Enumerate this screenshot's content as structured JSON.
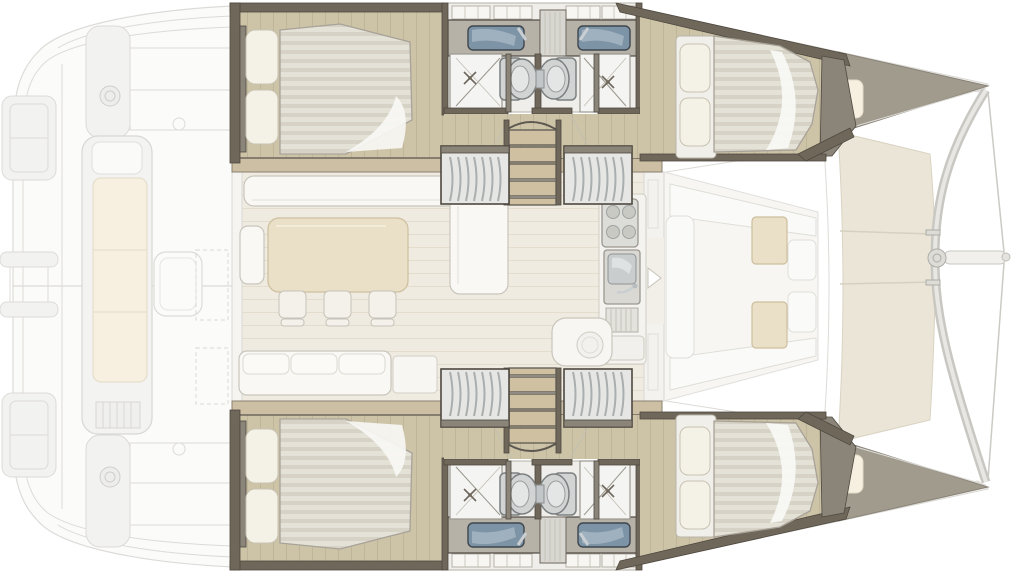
{
  "meta": {
    "title": "Catamaran interior floor plan (top-down)",
    "orientation": "bow-right-stern-left",
    "style": "rendered architectural layout, exterior decks ghosted"
  },
  "vessel": {
    "type": "sailing-catamaran",
    "double-cabins": 4,
    "double-berths": 4,
    "bathrooms": 4,
    "showers": 4,
    "toilets": 4,
    "washbasins": 4,
    "wardrobes": 4,
    "companionway-stairs": 2,
    "saloon-dining-chairs": 3,
    "stove-burners": 4,
    "forward-cockpit-tables": 2,
    "aft-cockpit-tables": 1,
    "trampoline-panels": 3
  },
  "rooms": [
    {
      "id": "aft-cockpit",
      "desc": "ghosted aft cockpit with long bench, table and davits"
    },
    {
      "id": "saloon",
      "desc": "saloon with L-sofa, dining table, three chairs and galley"
    },
    {
      "id": "galley",
      "desc": "galley strip with stove, sink and drainer"
    },
    {
      "id": "port-aft-cabin",
      "desc": "double cabin, bed head to port side"
    },
    {
      "id": "port-forward-cabin",
      "desc": "double cabin tapering into bow"
    },
    {
      "id": "starboard-aft-cabin",
      "desc": "double cabin, mirror of port"
    },
    {
      "id": "starboard-forward-cabin",
      "desc": "double cabin, mirror of port"
    },
    {
      "id": "heads",
      "desc": "two back-to-back bathroom pairs with sinks, toilets, showers"
    },
    {
      "id": "forward-cockpit",
      "desc": "U-shaped lounge with two tables"
    },
    {
      "id": "bow",
      "desc": "trampoline, crossbeam, bowsprit and bridles"
    }
  ],
  "colors": {
    "page-bg": "#ffffff",
    "ghost-fill": "#fbfbf9",
    "ghost-line": "#dcdbd7",
    "wall-dark": "#6f6759",
    "wall-mid": "#8b8478",
    "wall-edge": "#4e4940",
    "trim-wood": "#cdbfa4",
    "trim-edge": "#8a8070",
    "wood-floor": "#cdc4a8",
    "wood-line": "#bfb598",
    "saloon-floor": "#f0ebe0",
    "saloon-line": "#e4ddce",
    "mattress": "#e4e1d6",
    "mattress-stripe": "#d6d2c5",
    "mattress-edge": "#a8a298",
    "linen-white": "#f8f8f5",
    "pillow": "#f4f1e7",
    "pillow-edge": "#c7c2b2",
    "sofa-white": "#f9f8f4",
    "sofa-edge": "#c8c5bc",
    "cushion-cream": "#f7f0e1",
    "cushion-edge": "#e3dac6",
    "table-tan": "#eadfc7",
    "table-edge": "#cdbf9e",
    "chair": "#f3f1ea",
    "bath-floor": "#efeeea",
    "counter-gray": "#b7b2a8",
    "sink-blue": "#7d94a6",
    "sink-edge": "#3f464d",
    "chrome": "#c9ced2",
    "fixture-gray": "#d2d4d4",
    "fixture-edge": "#7c8081",
    "shower-white": "#f4f4f2",
    "steel": "#aaaeae",
    "closet-fill": "#e6e7e5",
    "step-wood": "#cfc0a2",
    "tramp-beige": "#eae5d7",
    "tramp-seam": "#d6d0c0",
    "bow-deck-gray": "#a19b8e",
    "beam-gray": "#c9c7c1"
  }
}
